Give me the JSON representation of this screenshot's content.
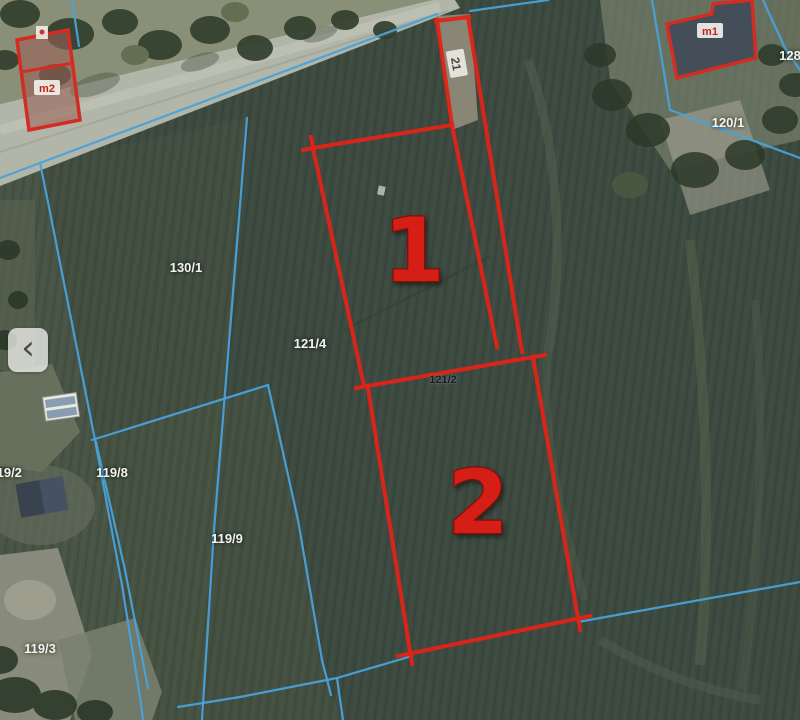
{
  "colors": {
    "highlight_red": "#e02318",
    "cadastral_blue": "#49a2dc"
  },
  "map": {
    "parcel_numbers": {
      "one": "1",
      "two": "2"
    },
    "access_strip_label": "21",
    "divider_parcel_label": "121/2",
    "buildings": {
      "left_label": "m2",
      "right_label": "m1"
    },
    "parcel_labels": {
      "p130_1": "130/1",
      "p121_4": "121/4",
      "p120_1": "120/1",
      "p128": "128",
      "p119_2": "119/2",
      "p119_8": "119/8",
      "p119_9": "119/9",
      "p119_3": "119/3"
    }
  },
  "controls": {
    "back_chevron": "‹"
  }
}
